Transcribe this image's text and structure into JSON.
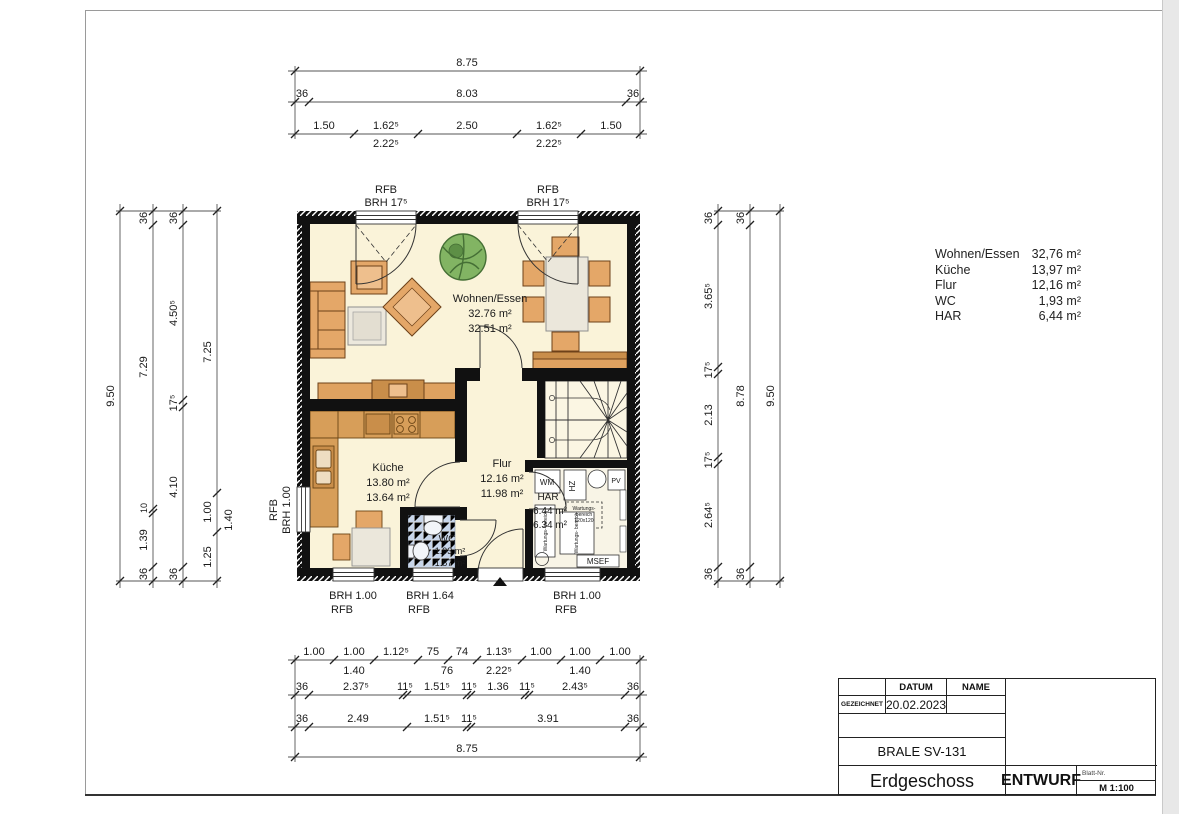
{
  "plan": {
    "windows": {
      "top_left": [
        "RFB",
        "BRH 17⁵"
      ],
      "top_right": [
        "RFB",
        "BRH 17⁵"
      ],
      "left": [
        "RFB",
        "BRH 1.00"
      ],
      "bottom_left": [
        "BRH 1.00",
        "RFB"
      ],
      "bottom_mid": [
        "BRH 1.64",
        "RFB"
      ],
      "bottom_right": [
        "BRH 1.00",
        "RFB"
      ]
    },
    "rooms": {
      "wohnen": [
        "Wohnen/Essen",
        "32.76 m²",
        "32.51 m²"
      ],
      "kueche": [
        "Küche",
        "13.80 m²",
        "13.64 m²"
      ],
      "flur": [
        "Flur",
        "12.16 m²",
        "11.98 m²"
      ],
      "har": [
        "HAR",
        "6.44 m²",
        "6.34 m²"
      ],
      "wc": [
        "WC",
        "1.93 m²",
        "1.87 m²"
      ]
    },
    "har_items": {
      "wm": "WM",
      "hz": "HZ",
      "pv": "PV",
      "msef": "MSEF",
      "service_box": [
        "Wartungs-",
        "bereich",
        "120x120"
      ],
      "side_left": "Wartungs- bereich",
      "side_mid": "Wartungs- bereich"
    }
  },
  "dims": {
    "top": {
      "total": "8.75",
      "row2": [
        "36",
        "8.03",
        "36"
      ],
      "row3": [
        "1.50",
        "1.62⁵",
        "2.50",
        "1.62⁵",
        "1.50"
      ],
      "row3_sub": [
        "2.22⁵",
        "2.22⁵"
      ]
    },
    "left": {
      "total": "9.50",
      "chain_b": [
        "36",
        "7.29",
        "10",
        "1.39",
        "36"
      ],
      "chain_c": [
        "36",
        "4.50⁵",
        "17⁵",
        "4.10",
        "36"
      ],
      "chain_d": [
        "7.25",
        "1.00",
        "1.25"
      ],
      "chain_d_sub": "1.40"
    },
    "right": {
      "chain_e": [
        "36",
        "3.65⁵",
        "17⁵",
        "2.13",
        "17⁵",
        "2.64⁵",
        "36"
      ],
      "chain_f": [
        "36",
        "8.78",
        "36"
      ],
      "total": "9.50"
    },
    "bottom": {
      "row1": [
        "1.00",
        "1.00",
        "1.12⁵",
        "75",
        "74",
        "1.13⁵",
        "1.00",
        "1.00",
        "1.00"
      ],
      "row1_sub": [
        "1.40",
        "76",
        "2.22⁵",
        "1.40"
      ],
      "row2": [
        "36",
        "2.37⁵",
        "11⁵",
        "1.51⁵",
        "11⁵",
        "1.36",
        "11⁵",
        "2.43⁵",
        "36"
      ],
      "row3": [
        "36",
        "2.49",
        "1.51⁵",
        "11⁵",
        "3.91",
        "36"
      ],
      "total": "8.75"
    }
  },
  "room_table": {
    "rows": [
      {
        "name": "Wohnen/Essen",
        "area": "32,76 m²"
      },
      {
        "name": "Küche",
        "area": "13,97 m²"
      },
      {
        "name": "Flur",
        "area": "12,16 m²"
      },
      {
        "name": "WC",
        "area": "1,93 m²"
      },
      {
        "name": "HAR",
        "area": "6,44 m²"
      }
    ]
  },
  "title_block": {
    "col_datum": "DATUM",
    "col_name": "NAME",
    "row_gezeichnet": "GEZEICHNET",
    "date": "20.02.2023",
    "doc_no": "BRALE SV-131",
    "title": "Erdgeschoss",
    "status": "ENTWURF",
    "blatt_label": "Blatt-Nr.",
    "scale": "M 1:100"
  }
}
